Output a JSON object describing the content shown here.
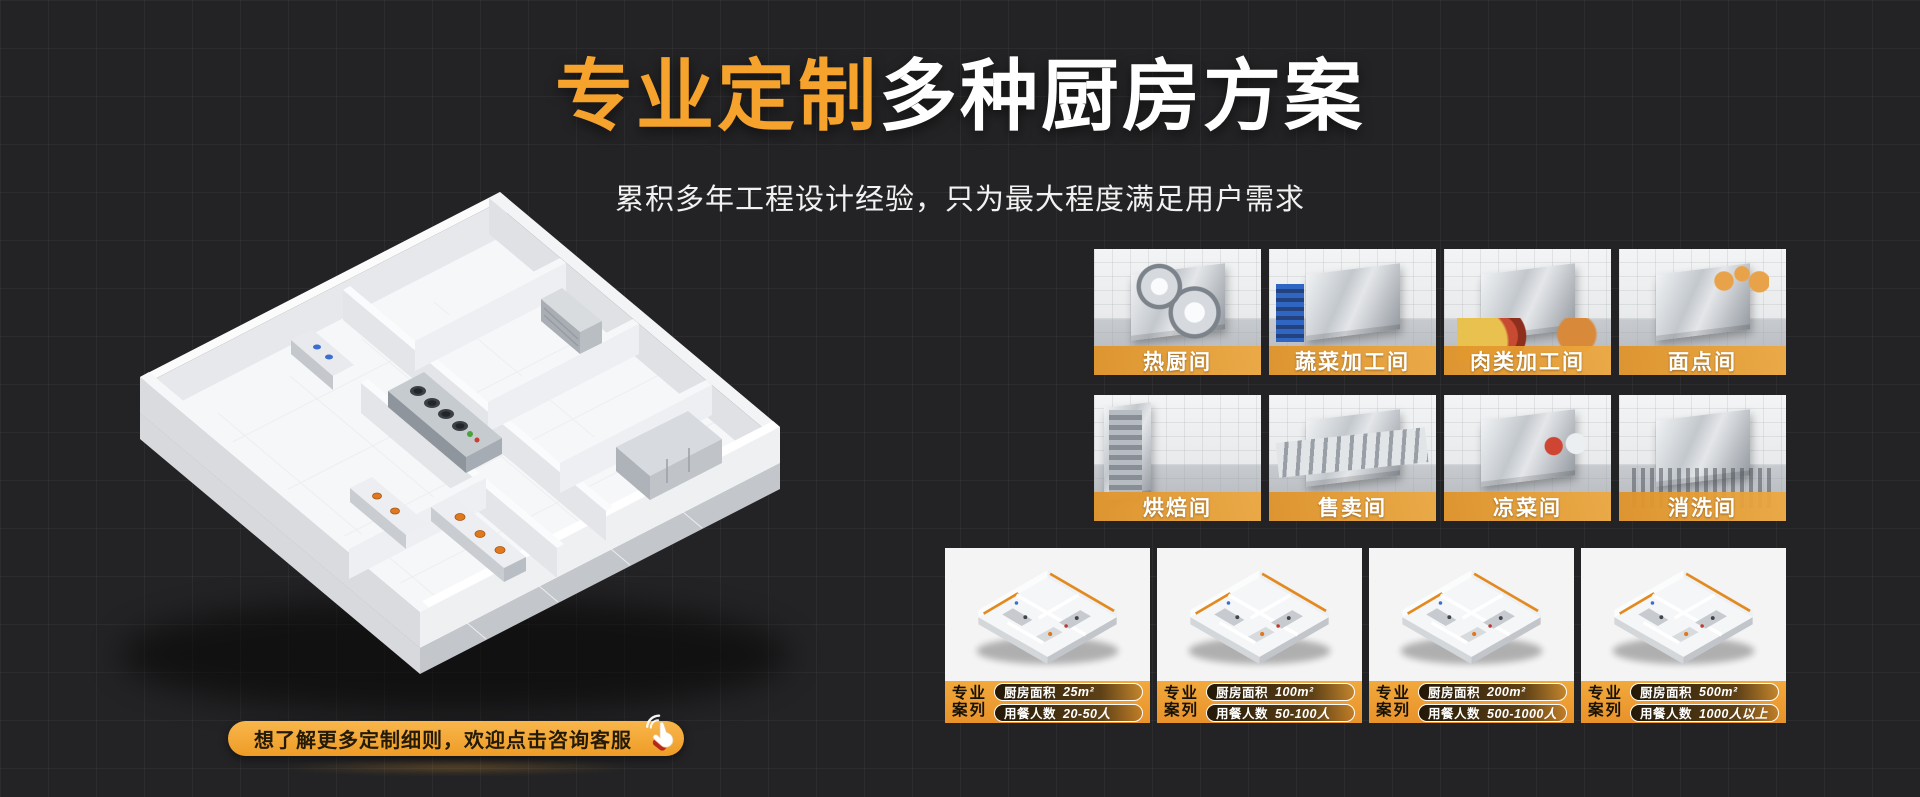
{
  "header": {
    "title_highlight": "专业定制",
    "title_rest": "多种厨房方案",
    "subtitle": "累积多年工程设计经验，只为最大程度满足用户需求"
  },
  "cta": {
    "label": "想了解更多定制细则，欢迎点击咨询客服",
    "icon": "click-hand-icon"
  },
  "rooms": [
    {
      "label": "热厨间"
    },
    {
      "label": "蔬菜加工间"
    },
    {
      "label": "肉类加工间"
    },
    {
      "label": "面点间"
    },
    {
      "label": "烘焙间"
    },
    {
      "label": "售卖间"
    },
    {
      "label": "凉菜间"
    },
    {
      "label": "消洗间"
    }
  ],
  "cases": [
    {
      "tag_line1": "专业",
      "tag_line2": "案列",
      "area_label": "厨房面积",
      "area_value": "25m²",
      "capacity_label": "用餐人数",
      "capacity_value": "20-50人"
    },
    {
      "tag_line1": "专业",
      "tag_line2": "案列",
      "area_label": "厨房面积",
      "area_value": "100m²",
      "capacity_label": "用餐人数",
      "capacity_value": "50-100人"
    },
    {
      "tag_line1": "专业",
      "tag_line2": "案列",
      "area_label": "厨房面积",
      "area_value": "200m²",
      "capacity_label": "用餐人数",
      "capacity_value": "500-1000人"
    },
    {
      "tag_line1": "专业",
      "tag_line2": "案列",
      "area_label": "厨房面积",
      "area_value": "500m²",
      "capacity_label": "用餐人数",
      "capacity_value": "1000人以上"
    }
  ],
  "colors": {
    "background": "#232325",
    "accent_orange": "#F5A32C",
    "room_label_bar": "#E79A36",
    "case_bar": "#EE9D32",
    "cta_gradient_top": "#F9B64B",
    "cta_gradient_bottom": "#EE9C26"
  }
}
